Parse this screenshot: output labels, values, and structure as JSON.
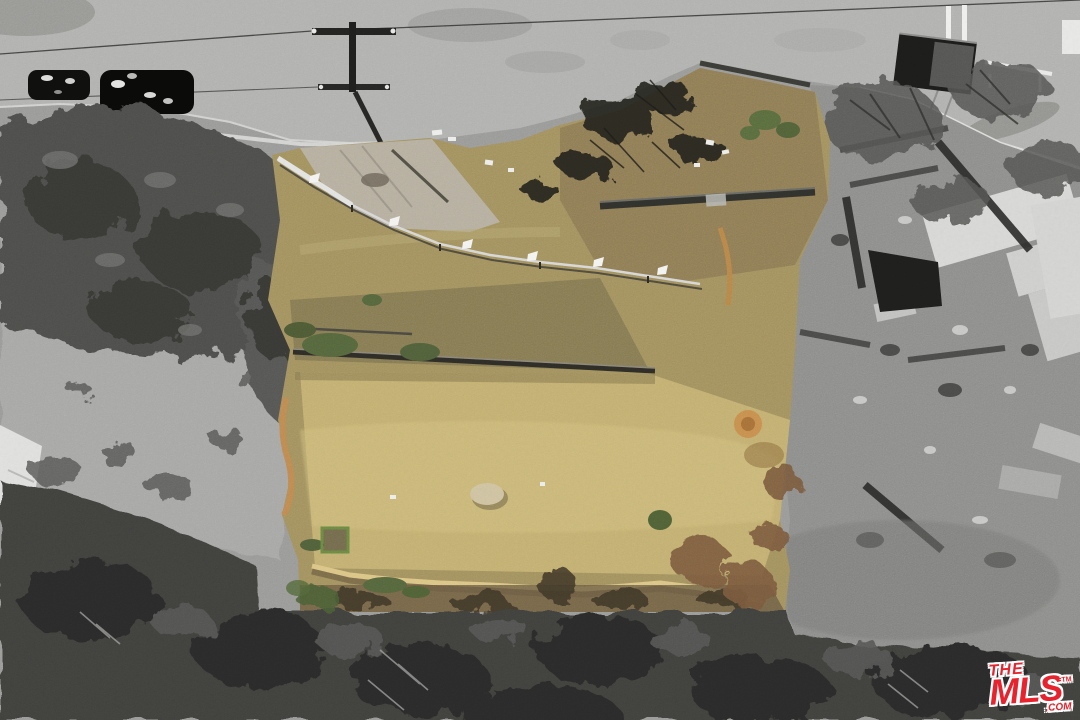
{
  "scene": {
    "title": "Aerial drone view of graded vacant lot highlighted in color amid grayscale fire-damaged surroundings",
    "regions": {
      "road": "Paved street curving along the top",
      "parked_cars": "Dark vehicles parked along the street",
      "utility_pole": "Utility pole with crossarms and shadow",
      "white_poles": "White poles and railing at street edge",
      "container": "Dark container on the pavement",
      "tree_canopy_left": "Large grayscale tree canopy, upper left",
      "left_clearing": "Gray dirt clearing with concrete pad, left side",
      "subject_lot": "Subject property: graded tan dirt lot shown in color",
      "concrete_apron": "Concrete driveway apron at street",
      "construction_fence": "Temporary chain-link fence with white flags",
      "retaining_wall": "Dark retaining wall lines across the lot",
      "sandbag_barrier": "Sandbag erosion barrier along lower edge of lot",
      "wattle_tubes": "Orange erosion-control wattle tubes at lot edges",
      "green_vegetation": "Green weeds and shrubs in the lot",
      "boulder": "Pale boulder in the graded pad",
      "green_frame": "Small green planter frame",
      "burnt_shrubs": "Burned black shrubs near the street",
      "ruins": "Burned structure ruins and rubble, grayscale right side",
      "bottom_trees": "Dense dark tree canopy along the bottom"
    }
  },
  "watermark": {
    "the": "THE",
    "mls": "MLS",
    "tm": "TM",
    "com": ".COM"
  },
  "colors": {
    "logo-red": "#e8232d",
    "lot-tan": "#a3925f",
    "lot-bright": "#c8b473",
    "lot-brown": "#8f7c55",
    "olive-band": "#7d7350",
    "road-gray": "#b2b2b0",
    "clearing-gray": "#a8a8a6",
    "canopy-gray": "#4e4e4c",
    "bottom-tree-gray": "#3f3f3d",
    "ruin-gray": "#8e8e8c",
    "slab-white": "#d8d8d6",
    "wall-dark": "#2e2c26",
    "fence-silver": "#d8d8d6",
    "flag-white": "#f4f4f2",
    "sandbag": "#dcc685",
    "wattle-orange": "#c08a50",
    "green-veg": "#55663c",
    "apron-concrete": "#b7b0a0"
  }
}
